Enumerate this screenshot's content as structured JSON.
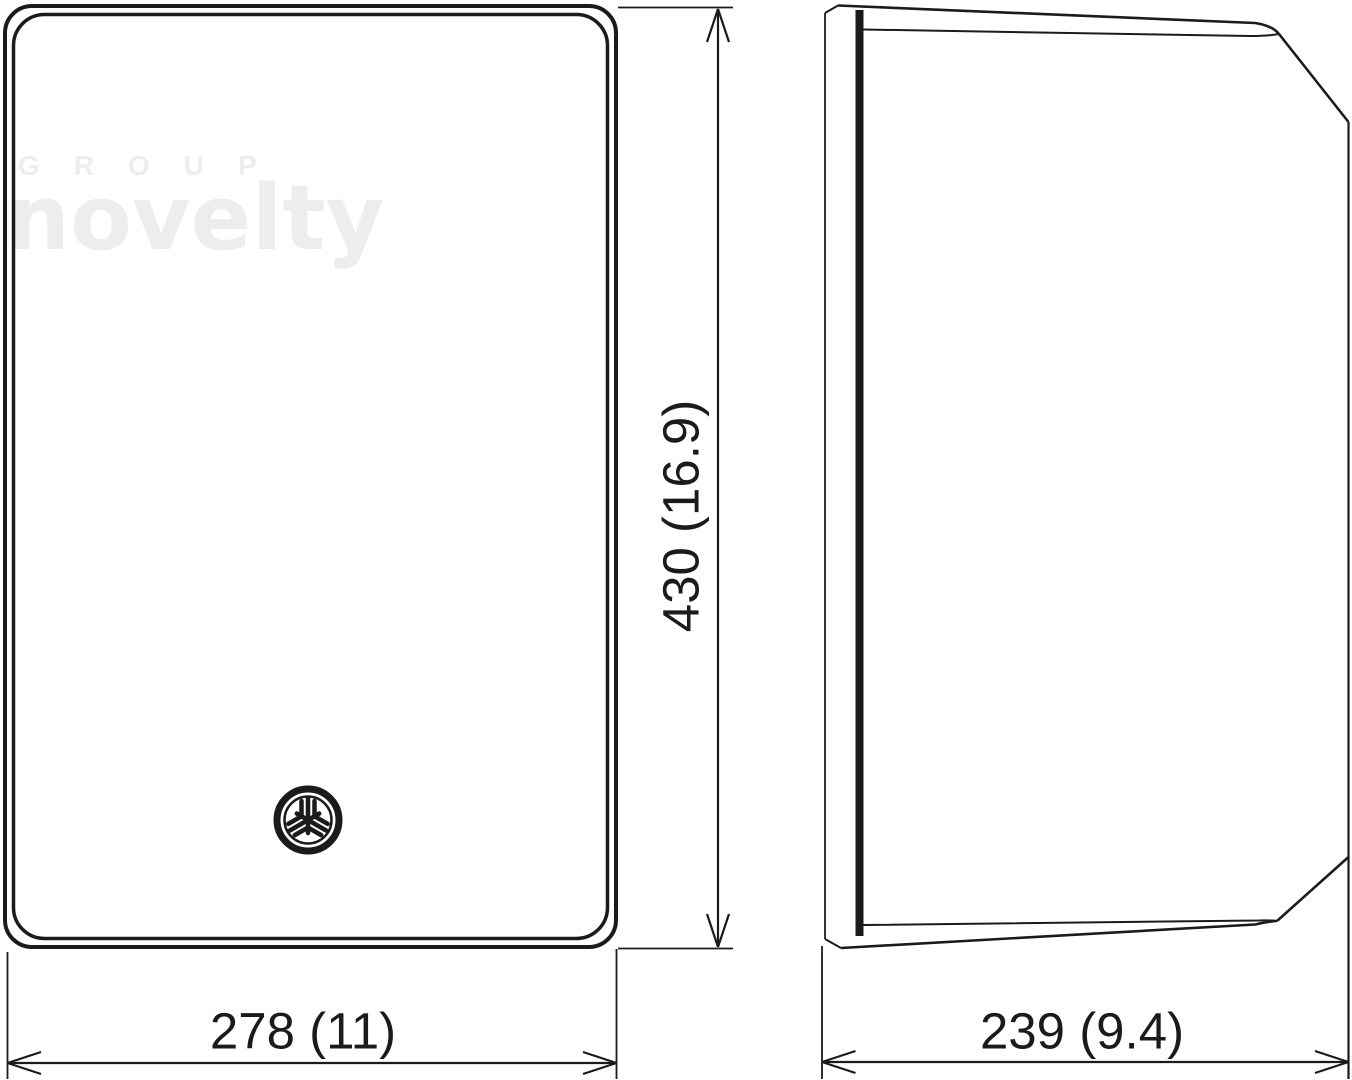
{
  "watermark": {
    "group": "GROUP",
    "novelty": "novelty"
  },
  "dimensions": {
    "height_label": "430 (16.9)",
    "front_width_label": "278 (11)",
    "side_depth_label": "239 (9.4)"
  },
  "icons": {
    "logo": "yamaha-tuning-fork-logo-icon"
  },
  "colors": {
    "line": "#1b1b1b",
    "watermark": "#ededed",
    "background": "#ffffff"
  }
}
